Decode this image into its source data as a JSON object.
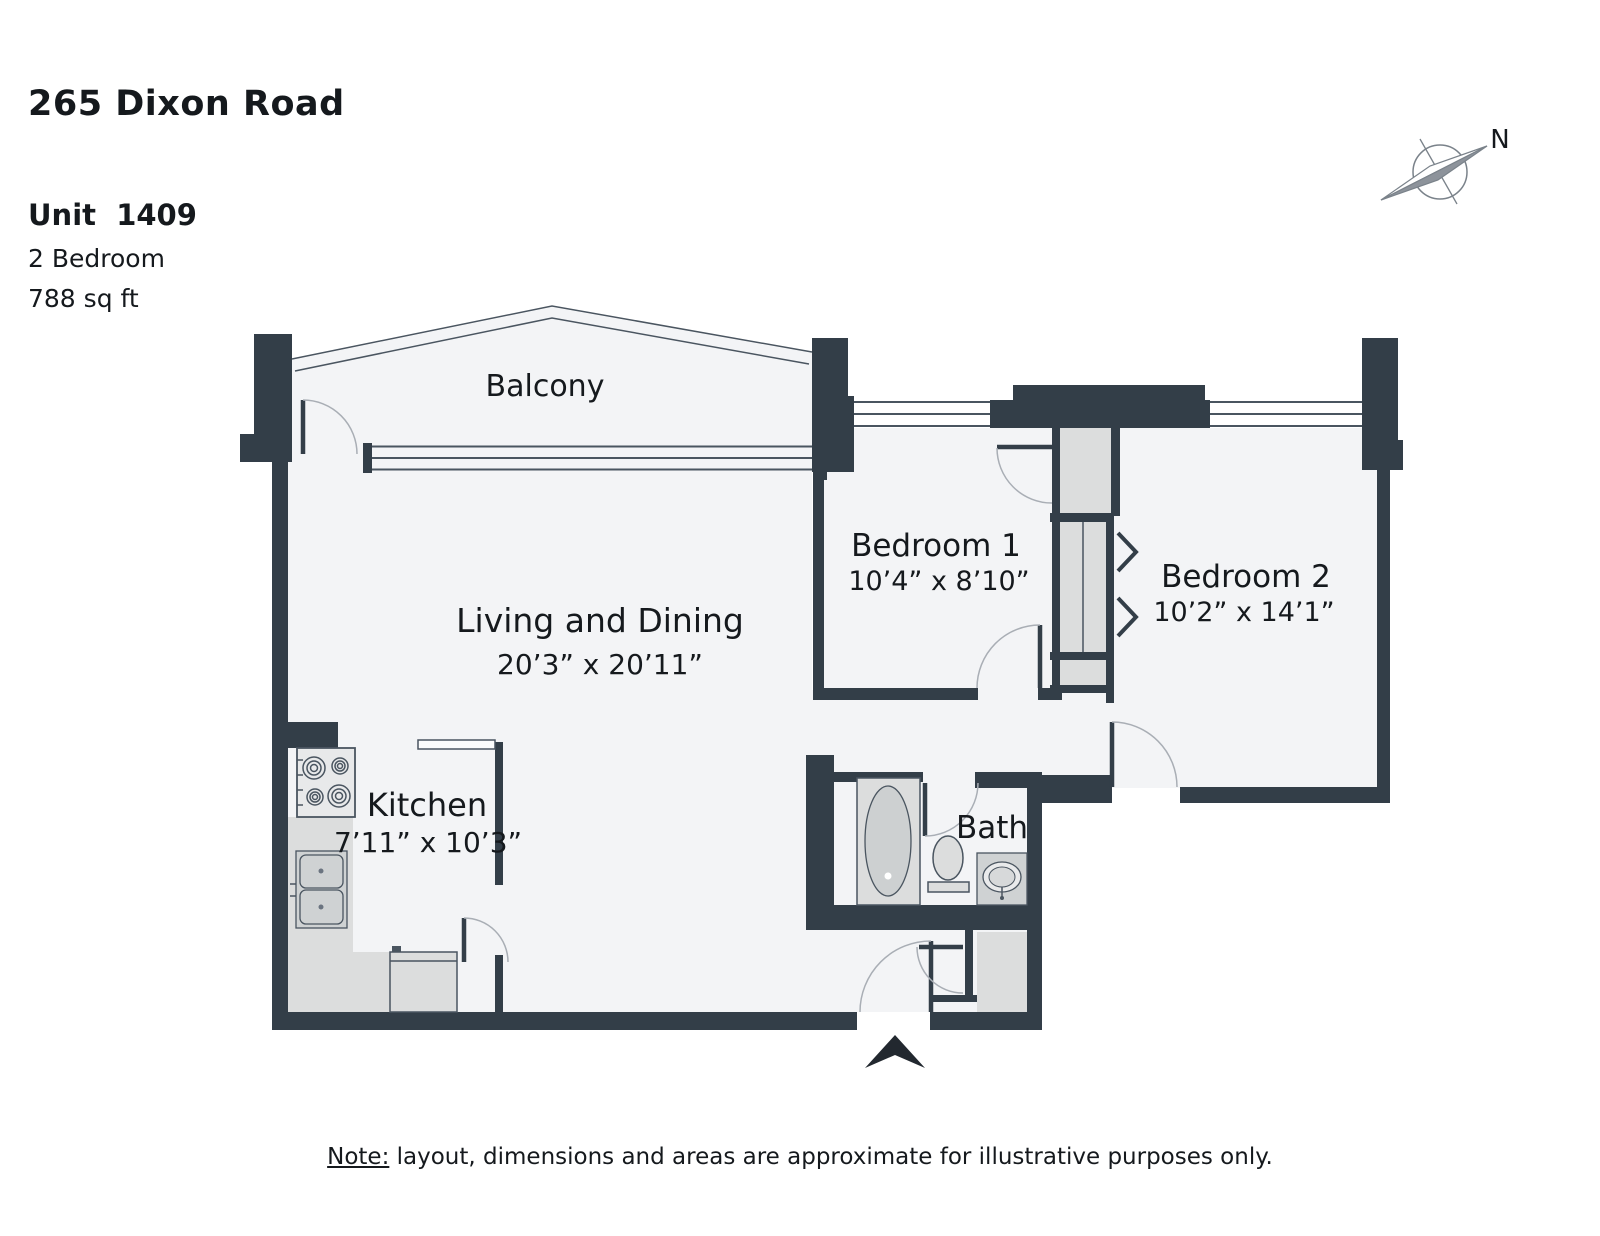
{
  "header": {
    "address": "265 Dixon Road",
    "unit": "Unit  1409",
    "bedrooms": "2 Bedroom",
    "area": "788 sq ft"
  },
  "compass": {
    "north": "N"
  },
  "rooms": {
    "balcony": {
      "name": "Balcony"
    },
    "living": {
      "name": "Living and Dining",
      "dims": "20’3” x 20’11”"
    },
    "kitchen": {
      "name": "Kitchen",
      "dims": "7’11” x 10’3”"
    },
    "bedroom1": {
      "name": "Bedroom 1",
      "dims": "10’4” x 8’10”"
    },
    "bedroom2": {
      "name": "Bedroom 2",
      "dims": "10’2” x 14’1”"
    },
    "bath": {
      "name": "Bath"
    }
  },
  "note": {
    "prefix": "Note:",
    "body": " layout, dimensions and areas are approximate for illustrative purposes only."
  },
  "colors": {
    "wall": "#333e48",
    "floor": "#f3f4f6",
    "fixture": "#dcdddd",
    "line": "#4a5560",
    "arc": "#a9aeb5",
    "text": "#15191d"
  }
}
